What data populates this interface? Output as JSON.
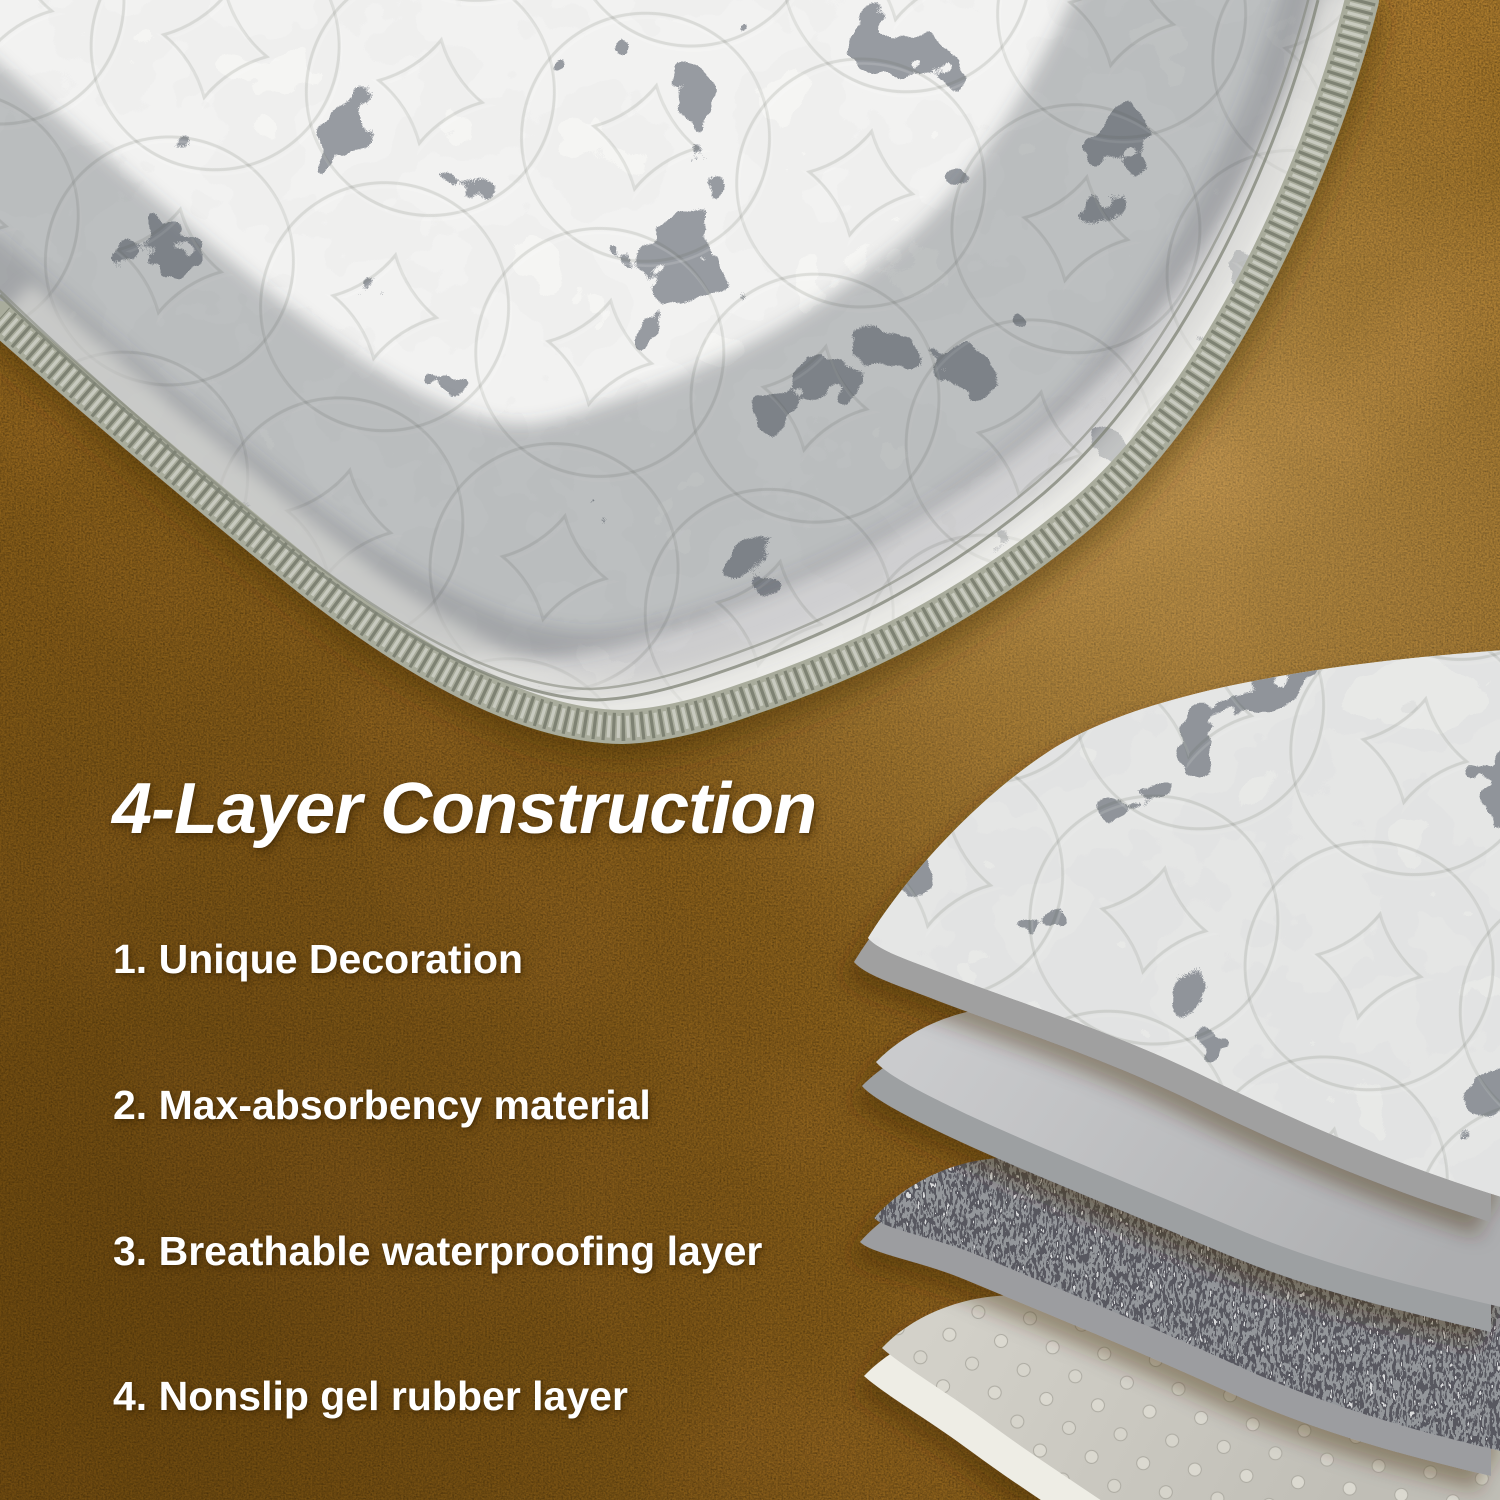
{
  "headline": {
    "text": "4-Layer Construction"
  },
  "features": {
    "items": [
      {
        "text": "1. Unique Decoration"
      },
      {
        "text": "2. Max-absorbency material"
      },
      {
        "text": "3. Breathable waterproofing layer"
      },
      {
        "text": "4. Nonslip gel rubber layer"
      }
    ]
  },
  "colors": {
    "text_white": "#ffffff",
    "floor_light": "#c28e47",
    "floor_mid": "#a9752b",
    "floor_dark": "#8a5c1a",
    "mat_base_light": "#dcdbd7",
    "mat_speckle_dark": "#44484e",
    "mat_border_sage": "#a9ac9c",
    "layer_absorbent_gray": "#bfc0c2",
    "layer_waterproof_dark": "#303236",
    "layer_gel_light": "#c9c7c0",
    "layer_underside_white": "#eeede5"
  }
}
